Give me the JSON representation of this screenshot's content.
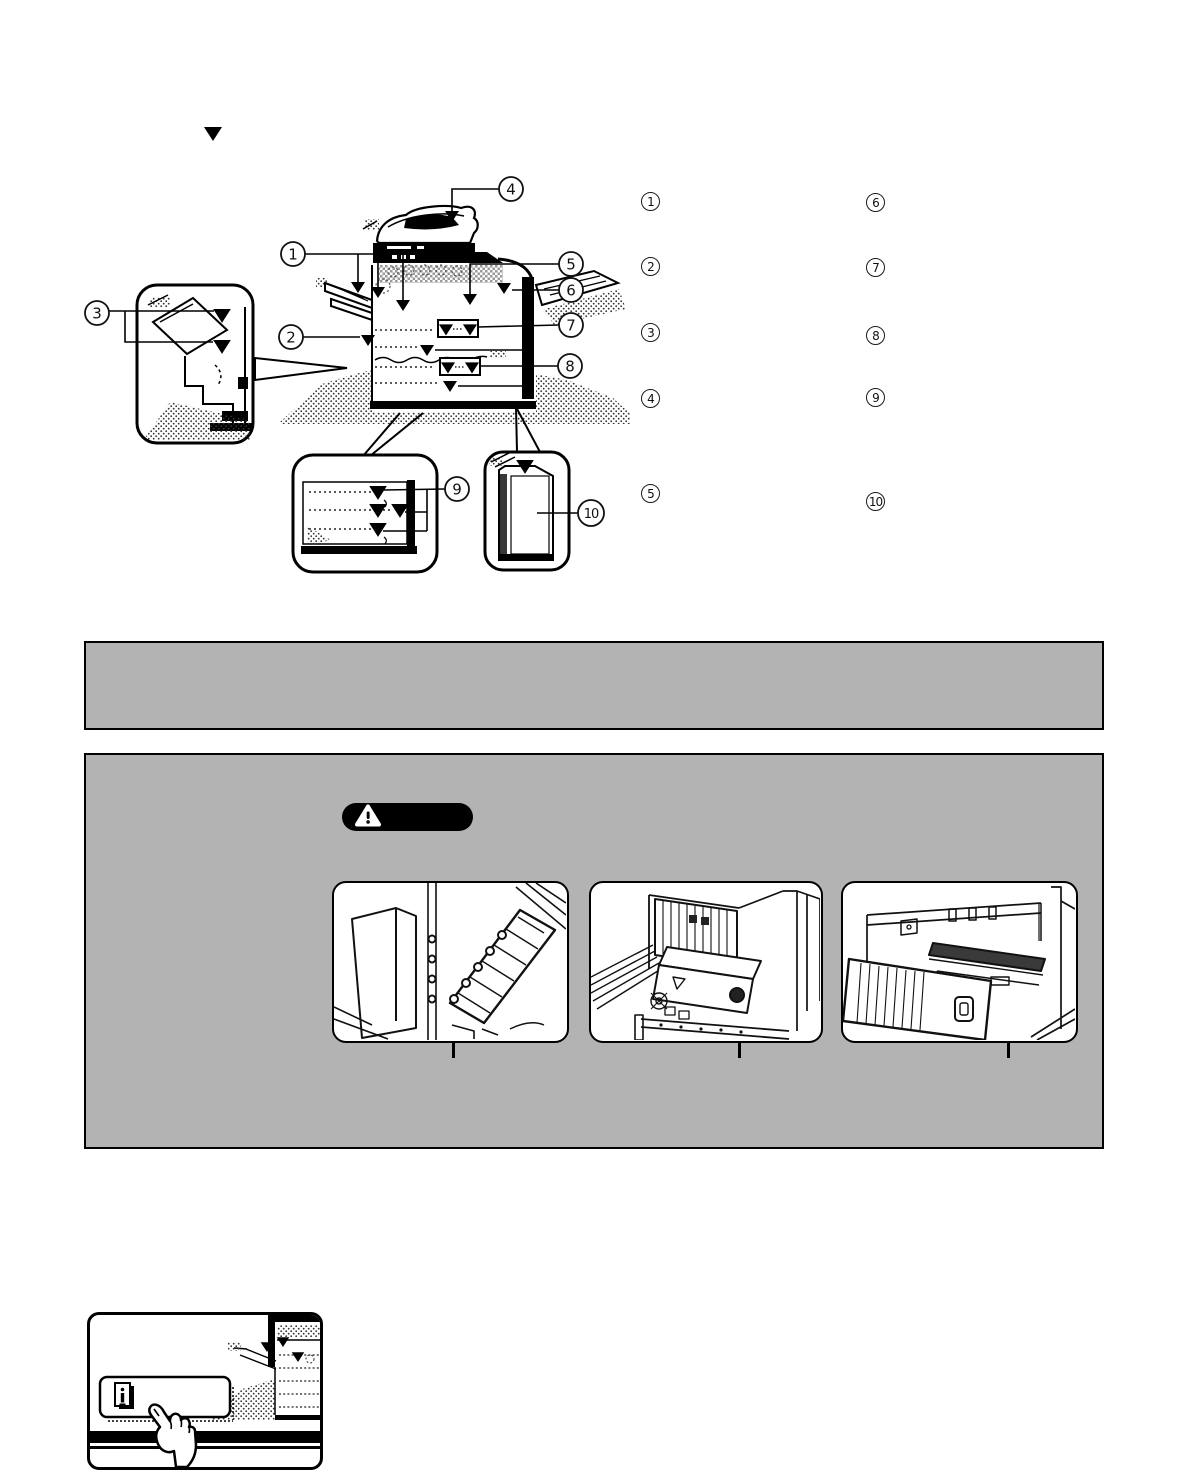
{
  "page": {
    "top_marker": "▼"
  },
  "colors": {
    "box_gray": "#b3b3b3",
    "ink": "#000000",
    "paper": "#ffffff"
  },
  "diagram": {
    "callouts": [
      "1",
      "2",
      "3",
      "4",
      "5",
      "6",
      "7",
      "8",
      "9",
      "10"
    ]
  },
  "legend": {
    "left_column": [
      "1",
      "2",
      "3",
      "4",
      "5"
    ],
    "right_column": [
      "6",
      "7",
      "8",
      "9",
      "10"
    ]
  },
  "icons": {
    "caution_badge": "warning-triangle-icon",
    "screen_button": "info-guide-icon",
    "screen_hand": "pointing-hand-icon",
    "location_marker": "down-triangle-marker"
  }
}
